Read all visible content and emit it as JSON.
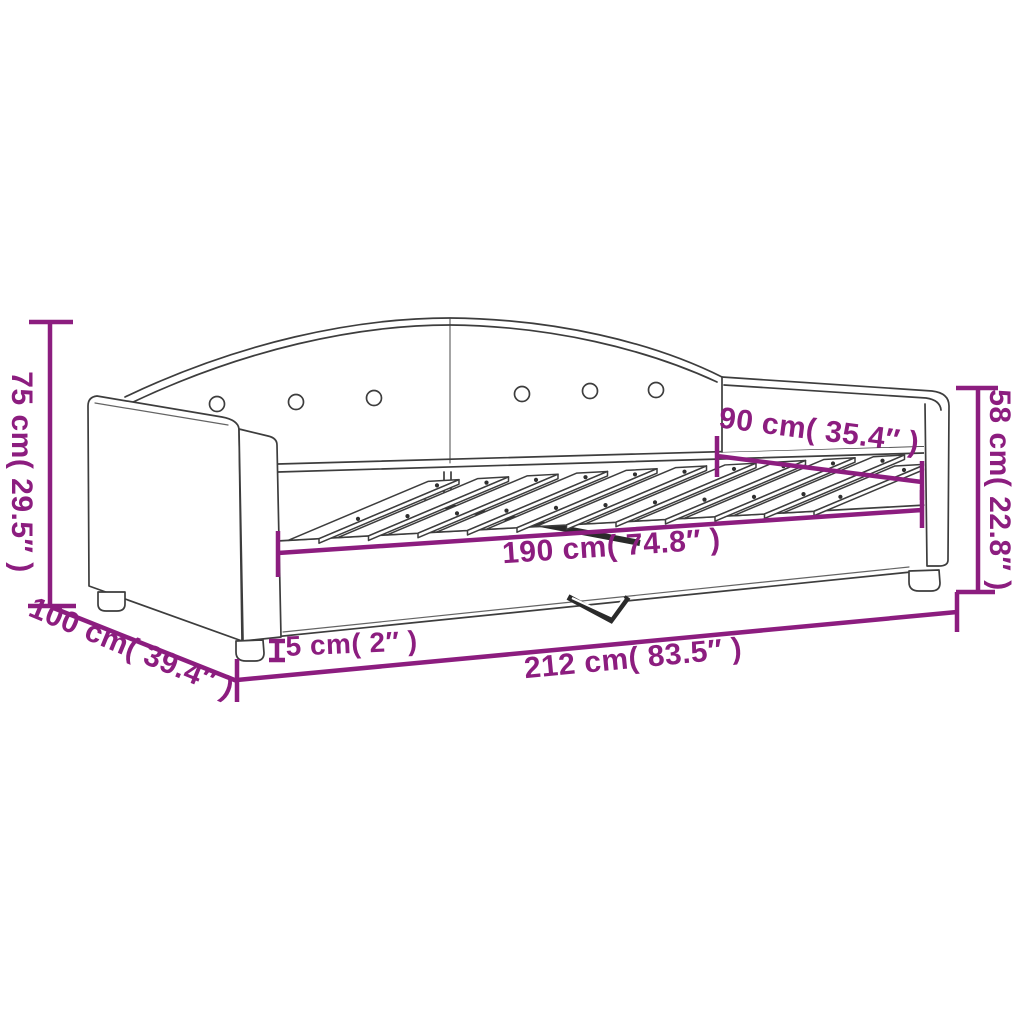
{
  "diagram": {
    "title": "Daybed dimension diagram",
    "style": {
      "accent_color": "#8C1D7F",
      "line_color": "#3D3D3D",
      "background": "#FFFFFF"
    },
    "product": {
      "type": "daybed with slatted bed base",
      "backrest_buttons": 6,
      "slats_visible": 11
    },
    "dimensions": {
      "height_total": {
        "label": "75 cm( 29.5″ )",
        "cm": "75 cm",
        "inches": "29.5″",
        "orientation": "vertical-left"
      },
      "depth_total": {
        "label": "100 cm( 39.4″ )",
        "cm": "100 cm",
        "inches": "39.4″",
        "orientation": "diagonal-bottom-left"
      },
      "slat_length": {
        "label": "190 cm( 74.8″ )",
        "cm": "190 cm",
        "inches": "74.8″",
        "orientation": "horizontal-middle"
      },
      "sleeping_width": {
        "label": "90 cm( 35.4″ )",
        "cm": "90 cm",
        "inches": "35.4″",
        "orientation": "diagonal-upper-right"
      },
      "height_arm": {
        "label": "58 cm( 22.8″ )",
        "cm": "58 cm",
        "inches": "22.8″",
        "orientation": "vertical-right"
      },
      "leg_height": {
        "label": "5 cm( 2″ )",
        "cm": "5 cm",
        "inches": "2″",
        "orientation": "vertical-small"
      },
      "length_total": {
        "label": "212 cm( 83.5″ )",
        "cm": "212 cm",
        "inches": "83.5″",
        "orientation": "horizontal-bottom"
      }
    }
  }
}
